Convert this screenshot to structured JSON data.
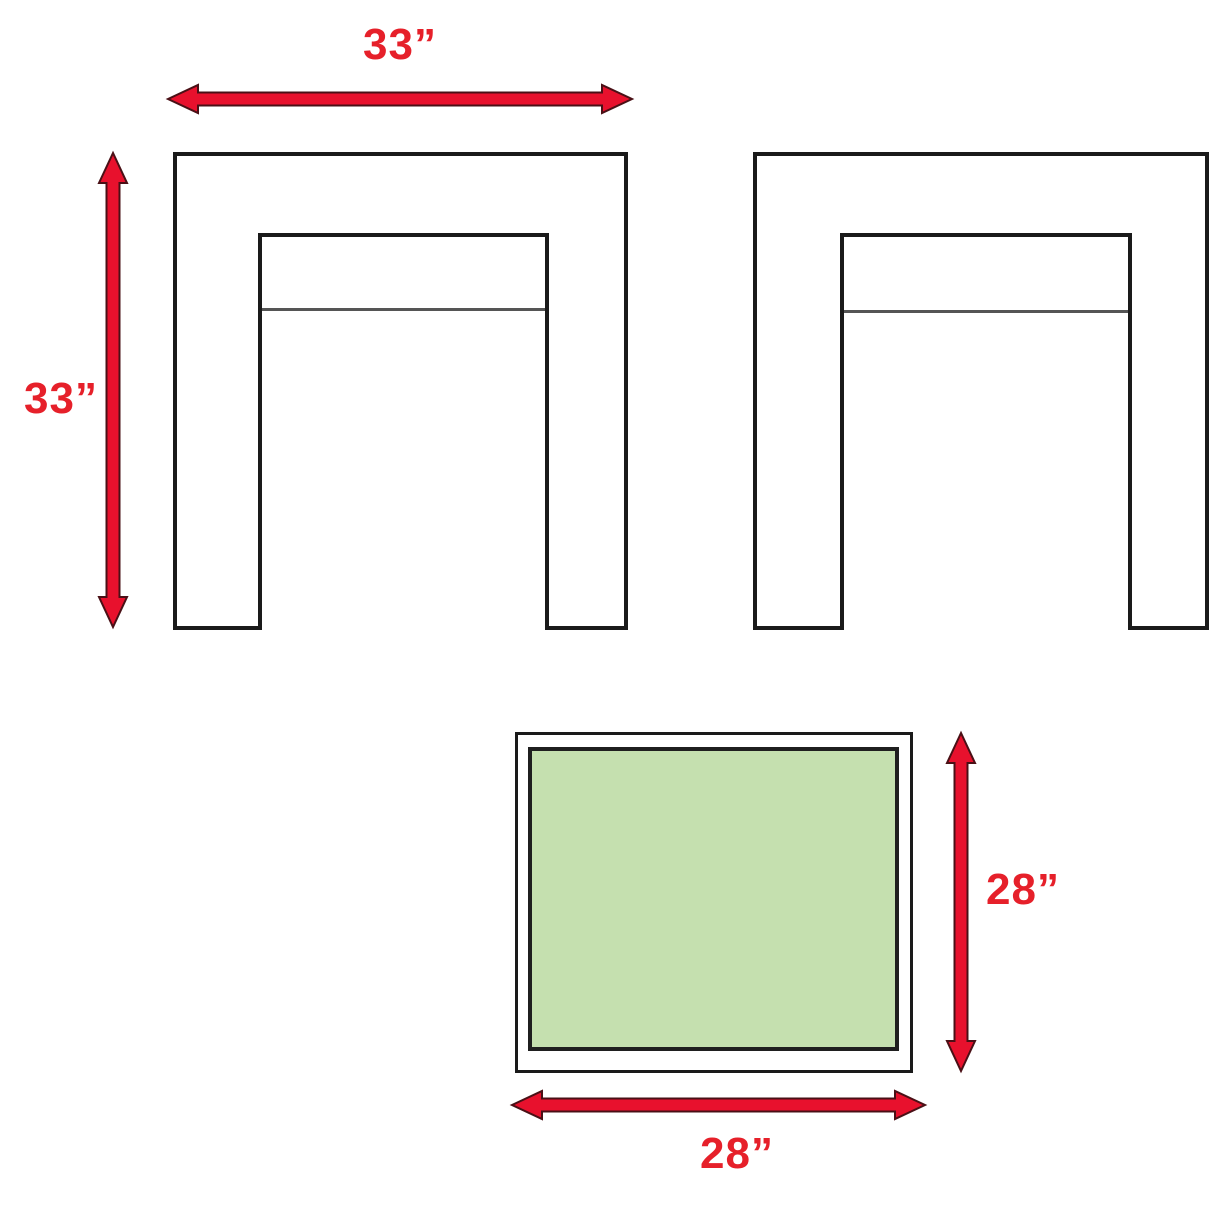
{
  "diagram": {
    "description": "Furniture dimension diagram: two armchair outlines and a green ottoman cushion with red measurement arrows",
    "labels": {
      "chair_width": "33”",
      "chair_height": "33”",
      "ottoman_height": "28”",
      "ottoman_width": "28”"
    },
    "colors": {
      "background": "#ffffff",
      "outline": "#1a1a1a",
      "seat_divider": "#555555",
      "arrow_fill": "#e8112d",
      "arrow_outline": "#4a1016",
      "label_text": "#e6202a",
      "cushion_fill": "#c5e0af"
    }
  }
}
